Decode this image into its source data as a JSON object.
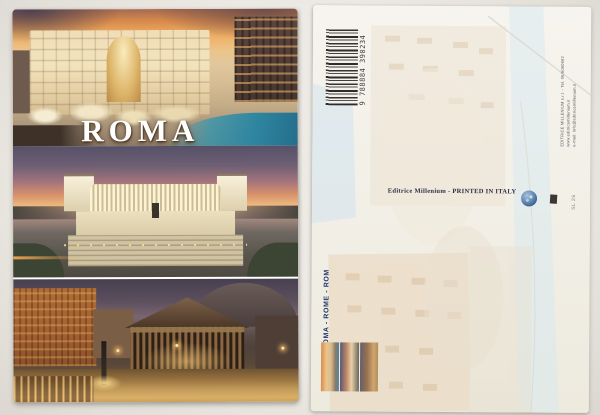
{
  "scene": {
    "description": "Front and back of a ROMA souvenir postcard lying on a light surface"
  },
  "front": {
    "title": "ROMA",
    "photos": [
      {
        "name": "trevi-fountain-sunset"
      },
      {
        "name": "vittoriano-monument-dusk"
      },
      {
        "name": "pantheon-piazza-night"
      }
    ]
  },
  "back": {
    "barcode_number": "9 788884 390234",
    "publisher_lines": [
      "EDITRICE MILLENIUM s.r.l. - Tel. 06/5060692",
      "www.editricemillenium.it",
      "e-mail: info@editricemillenium.it"
    ],
    "print_credit": "Editrice Millenium - PRINTED IN ITALY",
    "title_multilingual": "ROMA - ROME - ROM",
    "catalog_code": "SL 26"
  },
  "colors": {
    "page_background": "#e6e3dd",
    "card_front": "#ffffff",
    "card_back": "#f4f2ec",
    "navy_text": "#25356a",
    "credit_text": "#2c2c42",
    "title_text": "#ffffff"
  }
}
